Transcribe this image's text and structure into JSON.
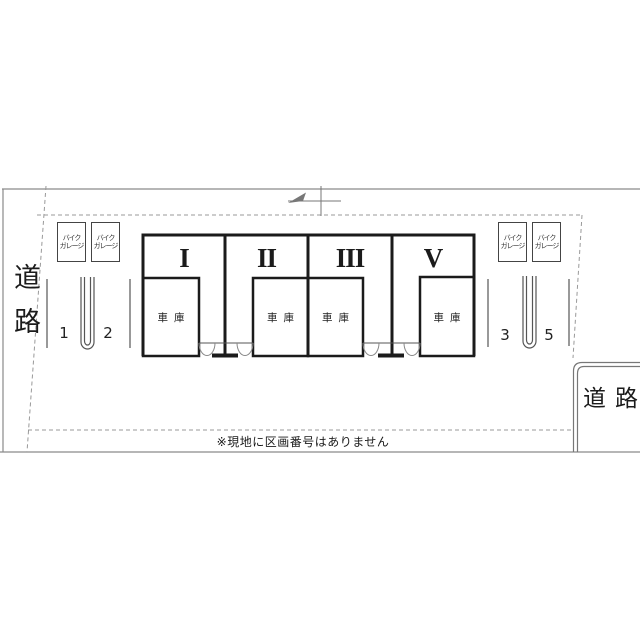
{
  "plan": {
    "type": "parking-lot-layout",
    "roads": {
      "left_label": "道路",
      "corner_label": "道路"
    },
    "footnote": "※現地に区画番号はありません",
    "bike_garage_label": {
      "line1": "バイク",
      "line2": "ガレージ"
    },
    "units": [
      {
        "numeral": "I",
        "room": "車庫"
      },
      {
        "numeral": "II",
        "room": "車庫"
      },
      {
        "numeral": "III",
        "room": "車庫"
      },
      {
        "numeral": "V",
        "room": "車庫"
      }
    ],
    "spots": [
      "1",
      "2",
      "3",
      "5"
    ],
    "colors": {
      "building_line": "#1b1b1b",
      "boundary_line": "#8a8a8a",
      "detail_line": "#777777",
      "background": "#ffffff"
    }
  }
}
